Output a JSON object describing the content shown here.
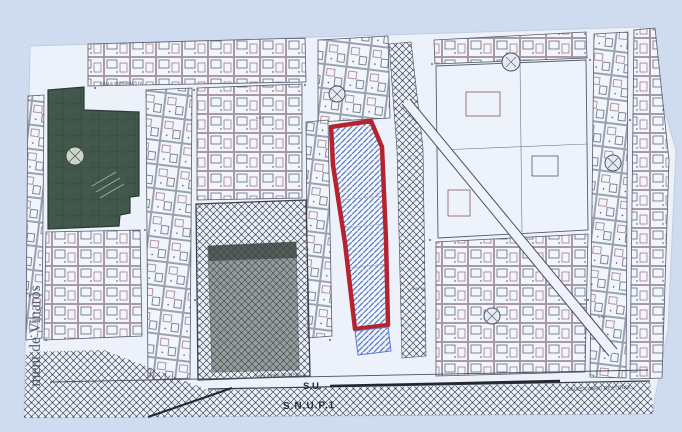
{
  "document": {
    "kind": "scanned cadastral / urban planning map",
    "municipality_stamp": "ment de Vinaròs"
  },
  "labels": {
    "stamp": "ment de Vinaròs",
    "street_top": "CALLE BOVERALS IV",
    "street_bottom_small": "CALLE CAMPO DE FUTBOL",
    "street_bottom_right": "CALLE CAMPO DE FUTBOL",
    "zone_su": "S.U.",
    "zone_snup": "S.N.U.P.1"
  },
  "spot_numbers": {
    "a": "6.09",
    "b": "5.00.36",
    "c": "5.90"
  },
  "colors": {
    "margin_blue": "#cfdcef",
    "paper": "#ecf1fa",
    "line_dark": "#4a4f5e",
    "line_red": "#8a5560",
    "parcel_red": "#b42430",
    "hatch_blue": "#5b7cc0",
    "green_block": "#42584c",
    "lattice": "#4a4e59"
  }
}
